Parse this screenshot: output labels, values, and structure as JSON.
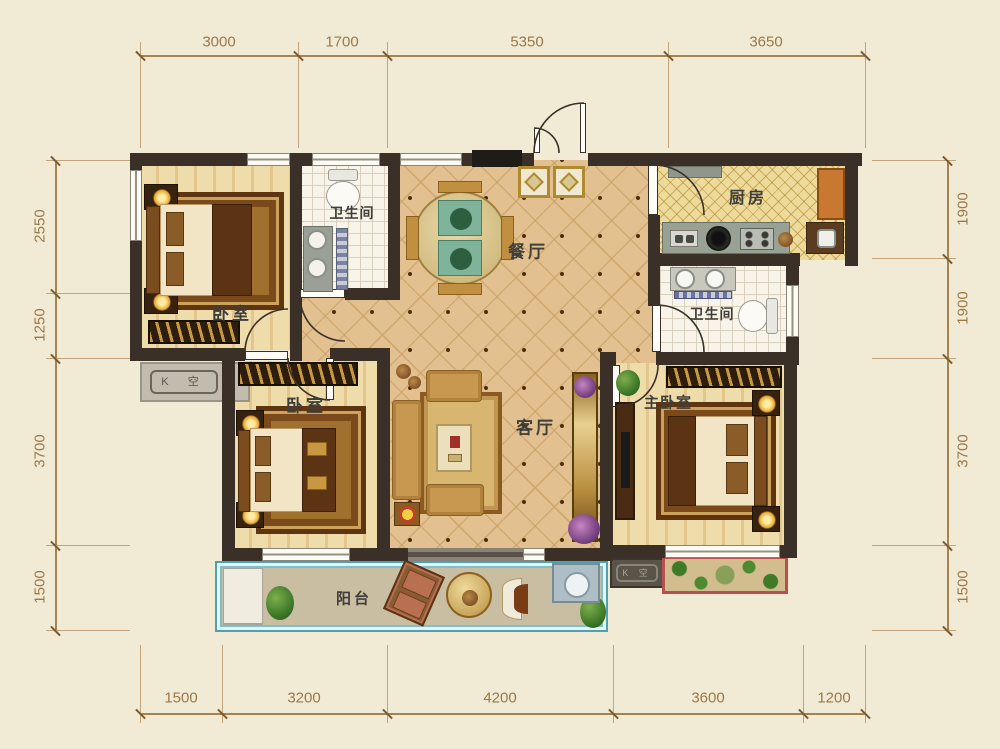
{
  "rooms": {
    "bedroom1": {
      "label": "卧室"
    },
    "bath1": {
      "label": "卫生间"
    },
    "dining": {
      "label": "餐厅"
    },
    "kitchen": {
      "label": "厨房"
    },
    "bath2": {
      "label": "卫生间"
    },
    "bedroom2": {
      "label": "卧室"
    },
    "living": {
      "label": "客厅"
    },
    "master": {
      "label": "主卧室"
    },
    "balcony": {
      "label": "阳台"
    }
  },
  "ac_platforms": {
    "left_label": "K 空",
    "bottom_label": "K 空"
  },
  "dimensions": {
    "top": [
      "3000",
      "1700",
      "5350",
      "3650"
    ],
    "bottom": [
      "1500",
      "3200",
      "4200",
      "3600",
      "1200"
    ],
    "left": [
      "2550",
      "1250",
      "3700",
      "1500"
    ],
    "right": [
      "1900",
      "1900",
      "3700",
      "1500"
    ]
  },
  "colors": {
    "wall": "#3a3027",
    "tile_floor": "#e3c08f",
    "wood_floor": "#eedcab",
    "balcony_border": "#4fa0b0",
    "dimension_text": "#9c7848"
  }
}
